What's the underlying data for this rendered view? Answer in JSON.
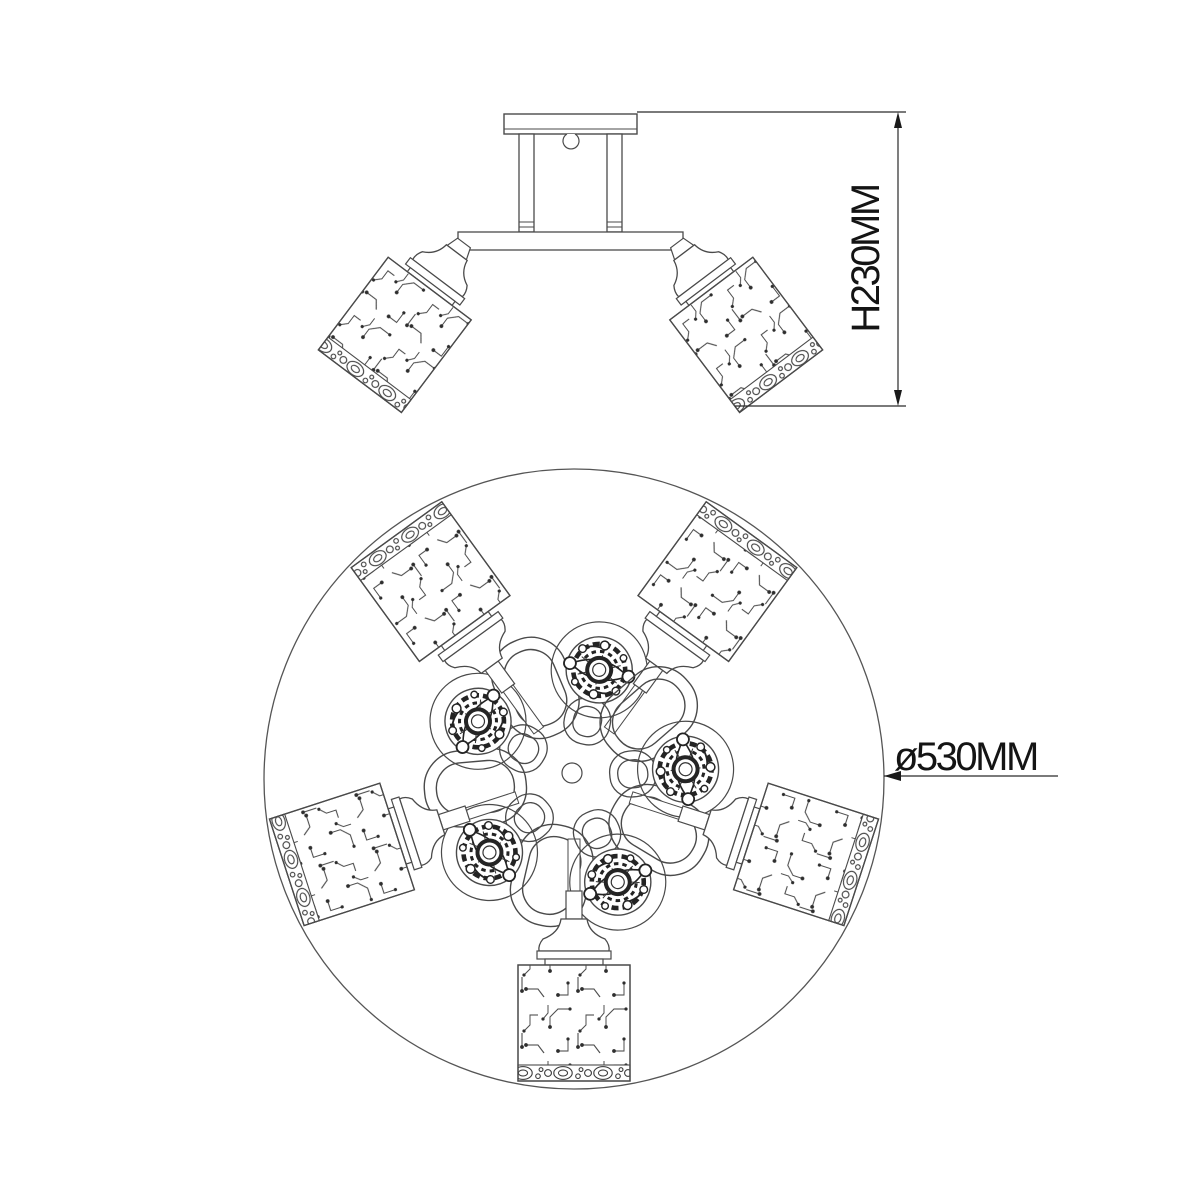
{
  "drawing": {
    "title_visible_text": "",
    "colors": {
      "background": "#ffffff",
      "ink": "#474747",
      "ornament_ink": "#232323",
      "dimension_ink": "#1a1a1a"
    },
    "height_dimension": {
      "label": "H230MM"
    },
    "diameter_dimension": {
      "label": "ø530MM"
    }
  }
}
